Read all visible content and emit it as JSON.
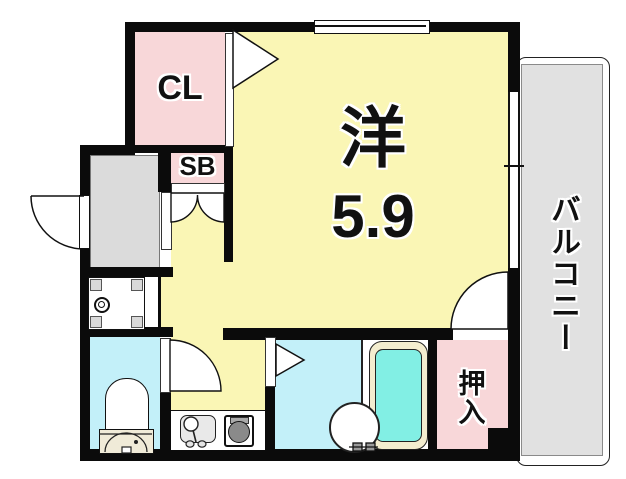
{
  "floorplan": {
    "rooms": {
      "closet": {
        "label": "CL"
      },
      "shoebox": {
        "label": "SB"
      },
      "western_room": {
        "label": "洋",
        "size": "5.9"
      },
      "oshiire": {
        "label": "押入"
      },
      "balcony": {
        "label": "バルコニー"
      }
    },
    "colors": {
      "wall": "#0b0b0b",
      "pink": "#f8d7d9",
      "yellow": "#faf6b5",
      "cyan": "#c3f0f9",
      "genkan": "#dbdbdb",
      "balcony-gray": "#e1e1e1",
      "tub-rim": "#f3edcf",
      "tub-water": "#82efe4",
      "tank": "#f0ebd8",
      "burner": "#8a8a8a",
      "fixture-gray": "#e9e9e9"
    },
    "fixtures": {
      "washer_pan": "washing-machine-pan",
      "toilet": "toilet",
      "bathtub": "bathtub",
      "washbasin": "washbasin",
      "kitchen_sink": "kitchen-sink",
      "stove": "stove-burner"
    }
  }
}
